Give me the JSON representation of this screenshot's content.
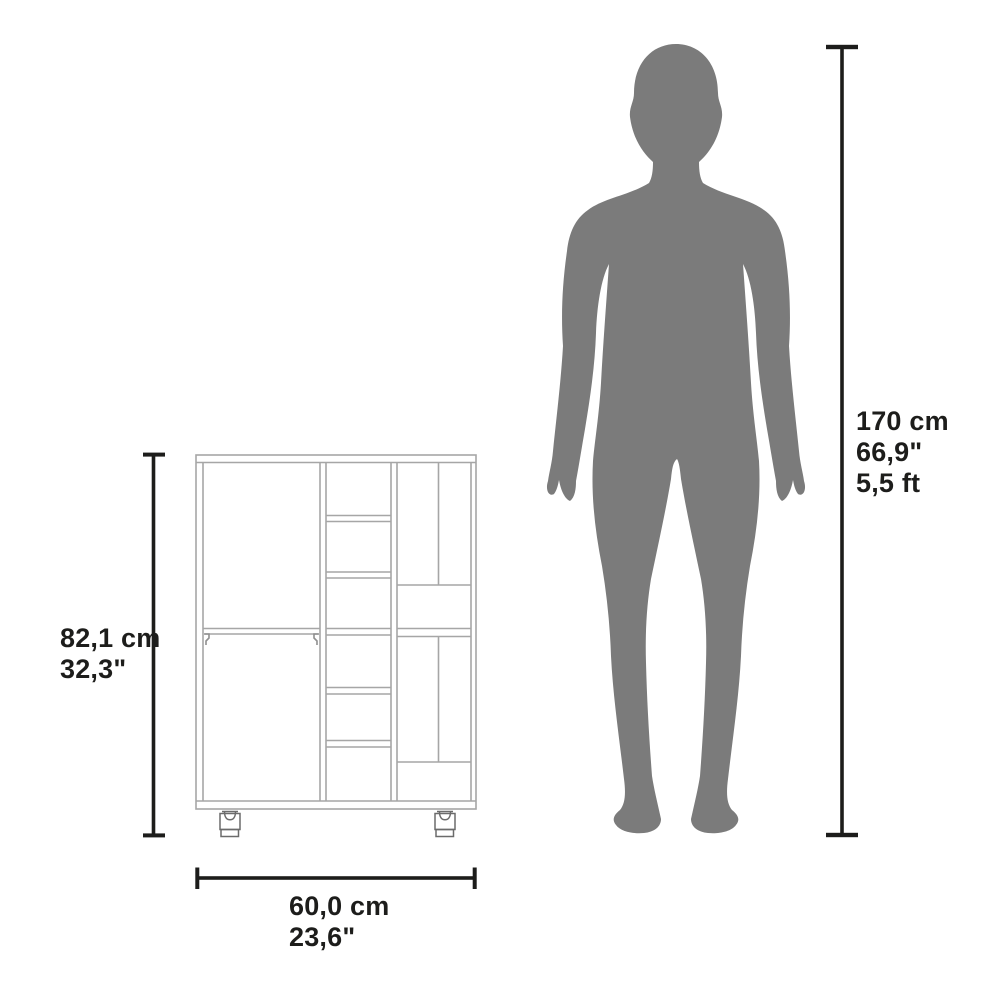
{
  "diagram": {
    "kind": "product dimension comparison diagram",
    "object": "bar cart cabinet with casters",
    "cabinet": {
      "height_cm": "82,1 cm",
      "height_in": "32,3\"",
      "width_cm": "60,0 cm",
      "width_in": "23,6\""
    },
    "person": {
      "height_cm": "170 cm",
      "height_in": "66,9\"",
      "height_ft": "5,5 ft"
    }
  },
  "colors": {
    "background": "#ffffff",
    "silhouette_gray": "#7b7b7b",
    "cabinet_line_gray": "#a6a6a6",
    "caster_line_gray": "#6b6b6b",
    "dimension_black": "#1d1d1b",
    "text_black": "#1d1d1b"
  }
}
